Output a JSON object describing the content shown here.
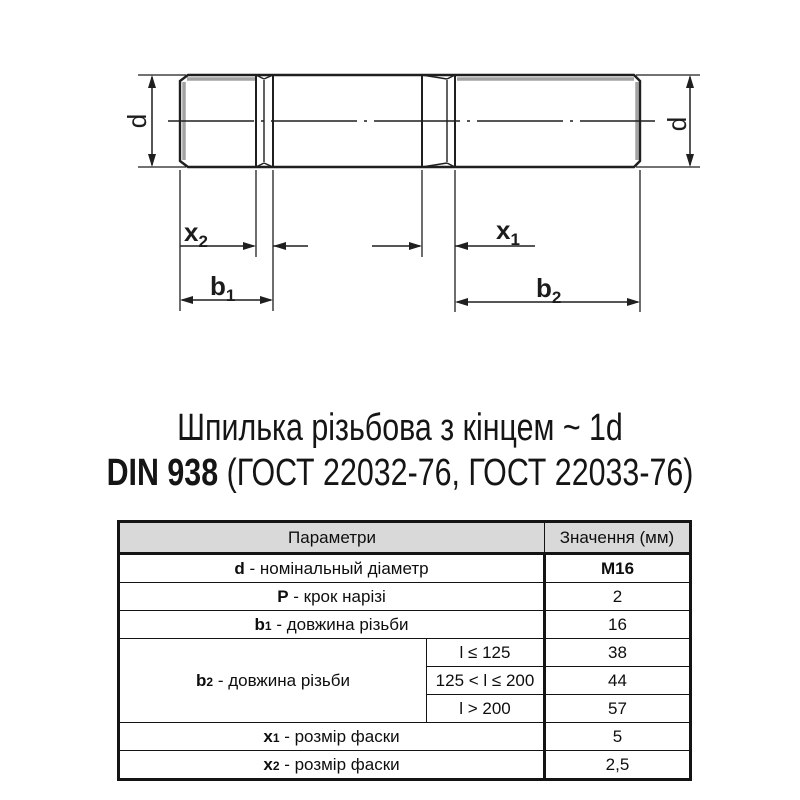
{
  "colors": {
    "line": "#1f1f1f",
    "thread_shade": "#a3a3a3",
    "header_bg": "#d9d9d9",
    "text": "#111111"
  },
  "drawing": {
    "dim_d_left": "d",
    "dim_d_right": "d",
    "dim_x2": {
      "base": "x",
      "sub": "2"
    },
    "dim_x1": {
      "base": "x",
      "sub": "1"
    },
    "dim_b1": {
      "base": "b",
      "sub": "1"
    },
    "dim_b2": {
      "base": "b",
      "sub": "2"
    }
  },
  "title": {
    "line1": "Шпилька різьбова з кінцем ~ 1d",
    "line2_bold": "DIN 938",
    "line2_rest": " (ГОСТ 22032-76, ГОСТ 22033-76)"
  },
  "table": {
    "header": {
      "params": "Параметри",
      "value": "Значення (мм)"
    },
    "row_d": {
      "sym": "d",
      "label": " - номінальный діаметр",
      "value": "M16"
    },
    "row_p": {
      "sym": "P",
      "label": " - крок нарізі",
      "value": "2"
    },
    "row_b1": {
      "sym": "b",
      "sub": "1",
      "label": " - довжина різьби",
      "value": "16"
    },
    "row_b2": {
      "sym": "b",
      "sub": "2",
      "label": " - довжина різьби",
      "conds": [
        {
          "cond": "l ≤ 125",
          "value": "38"
        },
        {
          "cond": "125 < l ≤ 200",
          "value": "44"
        },
        {
          "cond": "l > 200",
          "value": "57"
        }
      ]
    },
    "row_x1": {
      "sym": "x",
      "sub": "1",
      "label": " - розмір фаски",
      "value": "5"
    },
    "row_x2": {
      "sym": "x",
      "sub": "2",
      "label": " - розмір фаски",
      "value": "2,5"
    }
  }
}
